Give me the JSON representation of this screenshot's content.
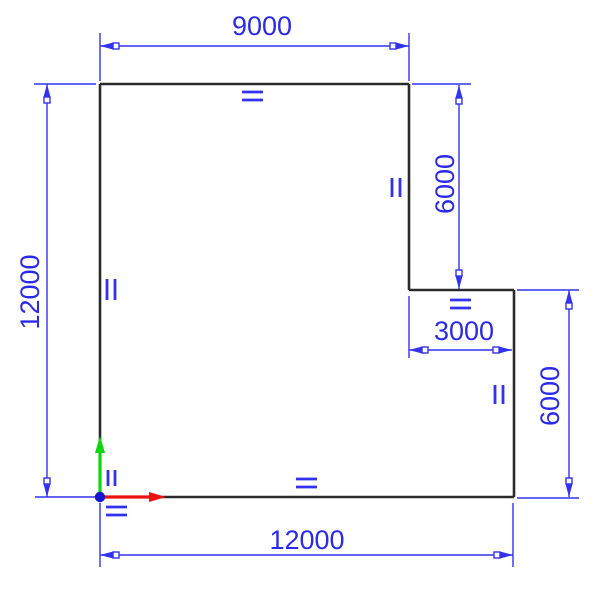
{
  "canvas": {
    "width": 604,
    "height": 598,
    "background": "#ffffff"
  },
  "palette": {
    "dimension_blue": "#3232f0",
    "text_blue": "#2a2aea",
    "geometry_black": "#2a2a2a",
    "x_axis_red": "#ee1111",
    "y_axis_green": "#0cd60c",
    "origin_blue": "#1717cf"
  },
  "sketch": {
    "description": "L-shaped closed sketch profile with linear dimensions, equal and parallel constraint glyphs, and a sketch origin triad",
    "profile_model_vertices": [
      [
        0,
        0
      ],
      [
        12000,
        0
      ],
      [
        12000,
        6000
      ],
      [
        9000,
        6000
      ],
      [
        9000,
        12000
      ],
      [
        0,
        12000
      ]
    ],
    "dimensions": [
      {
        "id": "top-width",
        "value": "9000",
        "orientation": "horizontal"
      },
      {
        "id": "left-height",
        "value": "12000",
        "orientation": "vertical"
      },
      {
        "id": "upper-right-height",
        "value": "6000",
        "orientation": "vertical"
      },
      {
        "id": "step-width",
        "value": "3000",
        "orientation": "horizontal"
      },
      {
        "id": "lower-right-height",
        "value": "6000",
        "orientation": "vertical"
      },
      {
        "id": "bottom-width",
        "value": "12000",
        "orientation": "horizontal"
      }
    ],
    "constraints": [
      {
        "id": "equal-top-edge",
        "type": "equal",
        "glyph": "="
      },
      {
        "id": "parallel-left-edge",
        "type": "parallel",
        "glyph": "||"
      },
      {
        "id": "parallel-upper-right-edge",
        "type": "parallel",
        "glyph": "||"
      },
      {
        "id": "equal-step-edge",
        "type": "equal",
        "glyph": "="
      },
      {
        "id": "parallel-lower-right-edge",
        "type": "parallel",
        "glyph": "||"
      },
      {
        "id": "equal-bottom-edge",
        "type": "equal",
        "glyph": "="
      },
      {
        "id": "parallel-origin",
        "type": "parallel",
        "glyph": "||"
      },
      {
        "id": "equal-origin",
        "type": "equal",
        "glyph": "="
      }
    ],
    "origin": {
      "icon": "coordinate-triad",
      "axes": [
        "x-axis-red",
        "y-axis-green"
      ]
    }
  }
}
